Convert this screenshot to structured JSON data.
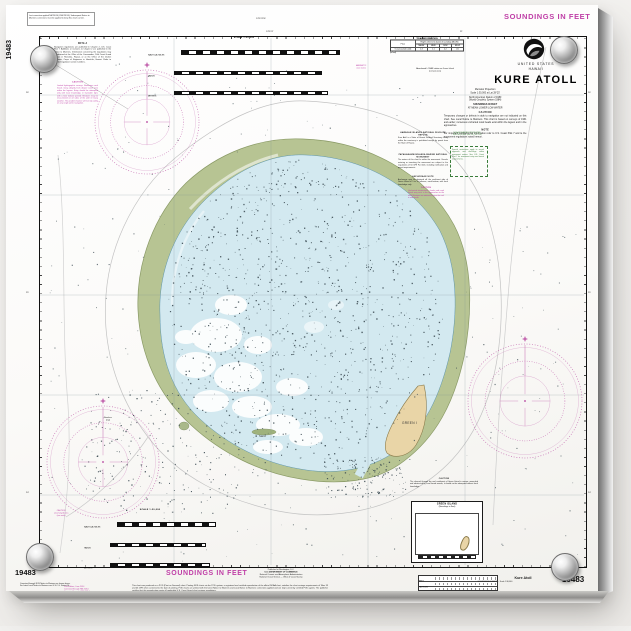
{
  "print": {
    "chart_number": "19483",
    "soundings_top": "SOUNDINGS IN FEET",
    "soundings_bottom": "SOUNDINGS IN FEET"
  },
  "margin_notes": {
    "top_left_1": "Last correction applied NM 26/14 (LNM 25/14).",
    "top_left_2": "Subsequent Notice to Mariners corrections must be applied to keep this chart current.",
    "top_center": "178°22'W",
    "bottom_left_1": "Corrected through NOS Notice to Mariners as shown above.",
    "bottom_left_2": "For latest Local Notice to Mariners see U.S.C.G. District 14.",
    "publisher_1": "Published at Washington, D.C.",
    "publisher_2": "U.S. DEPARTMENT OF COMMERCE",
    "publisher_3": "National Oceanic and Atmospheric Administration",
    "publisher_4": "National Ocean Service — Office of Coast Survey",
    "edition_block": "12th Edition, June 2014\nCorrected through NM 26/14\nCorrected through LNM 25/14\nCleared for Print on Demand",
    "certification": "This chart was produced as a POD (Print on Demand) chart. Printing NOS charts via the POD system, a registered and certified reproduction of the official NOAA chart, satisfies the chart carriage requirements of Titles 33 and 46 CFR when corrected to the date of printing. POD charts are printed with the latest Notice to Mariners and Local Notice to Mariners corrections applied and are kept current by certified POD agents. The publisher certifies that this reproduction meets all applicable U.S. Coast Guard chart carriage regulations.",
    "pod_label_1": "Kure Atoll",
    "pod_label_2": "SOUNDINGS IN FEET — Scale 1:30,000",
    "lat_labels": [
      "26'",
      "25'",
      "24'"
    ],
    "lon_labels": [
      "178°22'",
      "21'"
    ]
  },
  "title_block": {
    "agency_line1": "UNITED STATES",
    "agency_line2": "HAWAII",
    "title": "KURE ATOLL",
    "projection": "Mercator Projection",
    "scale": "Scale 1:30,000 at Lat 28°25'",
    "datum_line1": "North American Datum of 1983",
    "datum_line2": "(World Geodetic System 1984)",
    "soundings_line1": "SOUNDINGS IN FEET",
    "soundings_line2": "AT MEAN LOWER LOW WATER",
    "caution_heading": "CAUTION",
    "caution_body": "Temporary changes or defects in aids to navigation are not indicated on this chart. See Local Notice to Mariners. This chart is based on surveys of 1961 and earlier; numerous uncharted coral heads exist within the lagoon and in the approaches.",
    "note_heading": "NOTE",
    "note_body": "For important supplemental information refer to U.S. Coast Pilot 7 and to the monument regulations noted hereon."
  },
  "scale_bars": {
    "heading": "SCALE 1:30,000",
    "units": [
      "NAUTICAL MILES",
      "YARDS",
      "METERS"
    ]
  },
  "tide_table": {
    "title": "TIDAL INFORMATION",
    "place_header": "Place",
    "group_header": "Heights referred to datum of soundings (MLLW)",
    "cols": [
      "MHHW",
      "MHW",
      "MLW",
      "MLLW"
    ],
    "row_place": "Ocean (outside atoll)",
    "row_values": [
      "1.3",
      "1.1",
      "0.2",
      "0.0"
    ],
    "units_note": "(in feet)"
  },
  "notes": {
    "note_a_heading": "NOTE A",
    "note_a_body": "Navigation regulations are published in Chapter 2, U.S. Coast Pilot 7. Additions or revisions to Chapter 2 are published in the Notice to Mariners. Information concerning the regulations may be obtained at the Office of the Commander, 14th Coast Guard District in Honolulu, Hawaii, or at the Office of the District Engineer, Corps of Engineers in Honolulu, Hawaii. Refer to charted regulation section numbers.",
    "caution_nw_heading": "CAUTION",
    "caution_nw_body": "Limited hydrographic surveys. Numerous coral heads rising abruptly from deeper water exist within the lagoon. Entry should be attempted only with local knowledge, in favorable light, with a bow lookout posted. Breakers may be encountered on all sides of the atoll in heavy weather. The prudent mariner will not rely solely on any single aid to navigation.",
    "refuge_heading": "HAWAIIAN ISLANDS NATIONAL WILDLIFE REFUGE",
    "refuge_body": "Kure Atoll is a State of Hawaii Seabird Sanctuary. Entry within the sanctuary is prohibited except by permit from the State of Hawaii.",
    "monument_heading": "PAPAHANAUMOKUAKEA MARINE NATIONAL MONUMENT",
    "monument_body": "The waters of this chart lie within the monument. Vessels entering or transiting the monument are subject to the regulations of 50 CFR Part 404, including notification and permit requirements.",
    "anchorage_heading": "ANCHORAGE NOTE",
    "anchorage_body": "Anchorage may be obtained off the southeast side of Green Island in 5 to 10 fathoms, sand bottom, with local knowledge only.",
    "caution_east_heading": "CAUTION",
    "caution_east_body": "Uncharted obstructions, shoals and coral heads may exist in the approaches to the atoll. Mariners are advised to give the reef a wide berth.",
    "protected_1": "NOAA FISHERIES PROTECTED SPECIES ZONE (see 50 CFR 224)",
    "protected_2": "Special restrictions apply to vessel approach and discharge within monument waters. See U.S. Coast Pilot 7 for monument entry and transit requirements.",
    "caution_west": "CAUTION\nunsurveyed area\n(see note)",
    "magnetic_note": "MAGNETIC\n(see note)",
    "loran_note_1": "Abandoned LORAN station on Green Island",
    "loran_note_2": "(conspicuous)",
    "rose_label": "Breakers\n(rep)",
    "south_heading": "CAUTION",
    "south_body": "The channel through the reef southwest of Green Island is narrow, unmarked and obstructed by coral heads awash; it should not be attempted without local knowledge."
  },
  "map": {
    "green_island": "GREEN I",
    "sand_island": "Sand"
  },
  "inset": {
    "heading": "GREEN ISLAND",
    "subheading": "(Soundings in Feet)"
  },
  "colors": {
    "magenta": "#bf3ea6",
    "rose": "#c468b0",
    "reef": "#b7c493",
    "lagoon": "#d3e9f0",
    "sand": "#e9d5a7",
    "green_note": "#3a7d3a"
  }
}
